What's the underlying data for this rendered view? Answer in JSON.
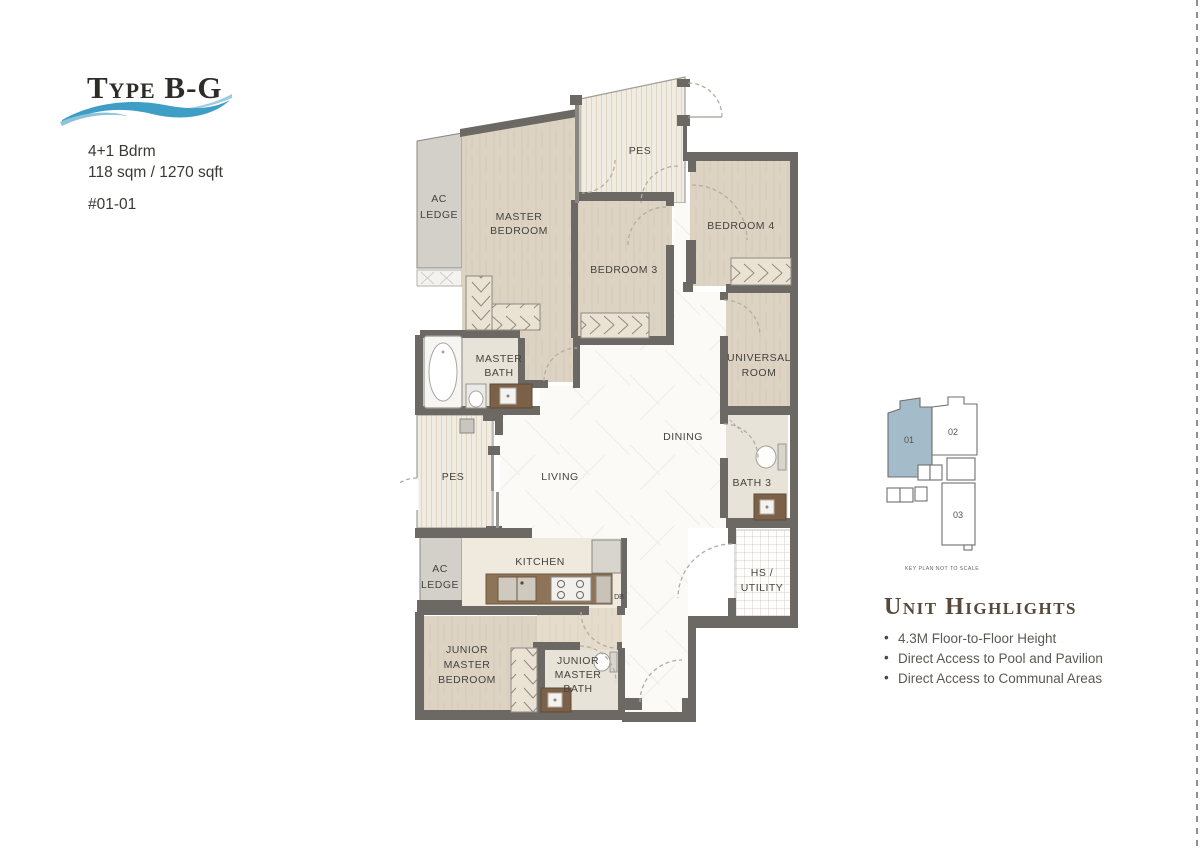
{
  "header": {
    "type_label": "Type B-G",
    "bedrooms": "4+1 Bdrm",
    "area": "118 sqm / 1270 sqft",
    "unit_number": "#01-01"
  },
  "floorplan": {
    "rooms": {
      "pes_top": "PES",
      "master_bedroom": [
        "MASTER",
        "BEDROOM"
      ],
      "bedroom3": "BEDROOM 3",
      "bedroom4": "BEDROOM 4",
      "ac_ledge_top": [
        "AC",
        "LEDGE"
      ],
      "master_bath": [
        "MASTER",
        "BATH"
      ],
      "universal_room": [
        "UNIVERSAL",
        "ROOM"
      ],
      "dining": "DINING",
      "living": "LIVING",
      "pes_lower": "PES",
      "bath3": "BATH 3",
      "ac_ledge_lower": [
        "AC",
        "LEDGE"
      ],
      "kitchen": "KITCHEN",
      "db": "DB",
      "hs_utility": [
        "HS /",
        "UTILITY"
      ],
      "junior_master_bedroom": [
        "JUNIOR",
        "MASTER",
        "BEDROOM"
      ],
      "junior_master_bath": [
        "JUNIOR",
        "MASTER",
        "BATH"
      ]
    }
  },
  "keyplan": {
    "units": [
      "01",
      "02",
      "03"
    ],
    "highlighted_unit": "01",
    "highlight_color": "#a4bcca",
    "caption": "KEY PLAN NOT TO SCALE"
  },
  "highlights": {
    "title": "Unit Highlights",
    "items": [
      "4.3M Floor-to-Floor Height",
      "Direct Access to Pool and Pavilion",
      "Direct Access to Communal Areas"
    ]
  },
  "colors": {
    "wave_blue_main": "#3f9ec6",
    "wave_blue_light": "#97cde0",
    "heading_brown": "#56493b",
    "wall_gray": "#6c6964"
  }
}
